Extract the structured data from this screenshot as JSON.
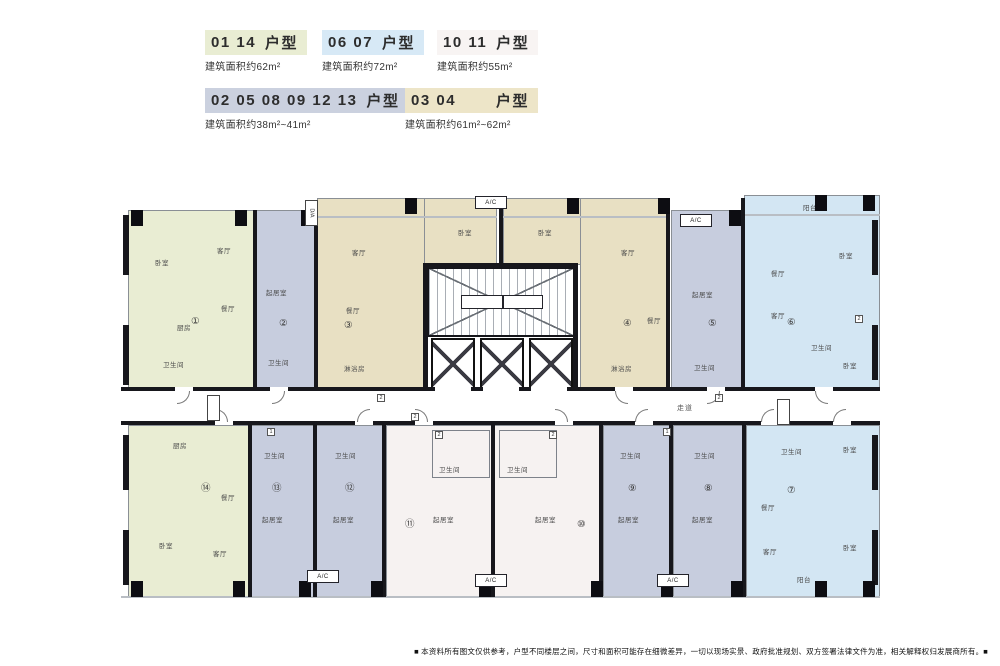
{
  "legend": {
    "row1": [
      {
        "nums": "01 14",
        "suffix": "户型",
        "area": "建筑面积约62m²",
        "color": "#e9edd3"
      },
      {
        "nums": "06 07",
        "suffix": "户型",
        "area": "建筑面积约72m²",
        "color": "#d7e9f6"
      },
      {
        "nums": "10 11",
        "suffix": "户型",
        "area": "建筑面积约55m²",
        "color": "#f8f4f3"
      }
    ],
    "row2": [
      {
        "nums": "02 05 08 09 12 13",
        "suffix": "户型",
        "area": "建筑面积约38m²~41m²",
        "color": "#cbd1df"
      },
      {
        "nums": "03 04",
        "suffix": "户型",
        "area": "建筑面积约61m²~62m²",
        "color": "#ede5c8"
      }
    ]
  },
  "plan": {
    "corridor_label": "走道",
    "ac_label": "A/C",
    "duct_label": "D/A",
    "units": [
      {
        "id": "01",
        "num": "①",
        "color": "#e9edd3"
      },
      {
        "id": "02",
        "num": "②",
        "color": "#c7cdde"
      },
      {
        "id": "03",
        "num": "③",
        "color": "#e8e0c3"
      },
      {
        "id": "04",
        "num": "④",
        "color": "#e8e0c3"
      },
      {
        "id": "05",
        "num": "⑤",
        "color": "#c7cdde"
      },
      {
        "id": "06",
        "num": "⑥",
        "color": "#d3e6f3"
      },
      {
        "id": "07",
        "num": "⑦",
        "color": "#d3e6f3"
      },
      {
        "id": "08",
        "num": "⑧",
        "color": "#c7cdde"
      },
      {
        "id": "09",
        "num": "⑨",
        "color": "#c7cdde"
      },
      {
        "id": "10",
        "num": "⑩",
        "color": "#f6f2f1"
      },
      {
        "id": "11",
        "num": "⑪",
        "color": "#f6f2f1"
      },
      {
        "id": "12",
        "num": "⑫",
        "color": "#c7cdde"
      },
      {
        "id": "13",
        "num": "⑬",
        "color": "#c7cdde"
      },
      {
        "id": "14",
        "num": "⑭",
        "color": "#e9edd3"
      }
    ]
  },
  "rooms": {
    "bedroom": "卧室",
    "living": "客厅",
    "dining": "餐厅",
    "kitchen": "厨房",
    "bath": "卫生间",
    "balcony": "阳台",
    "studio": "起居室",
    "shower": "淋浴房"
  },
  "badges": {
    "b1": "1",
    "b2": "2"
  },
  "disclaimer": "■ 本资料所有图文仅供参考，户型不同楼层之间，尺寸和面积可能存在细微差异，一切以现场实景、政府批准规划、双方签署法律文件为准，相关解释权归发展商所有。■"
}
